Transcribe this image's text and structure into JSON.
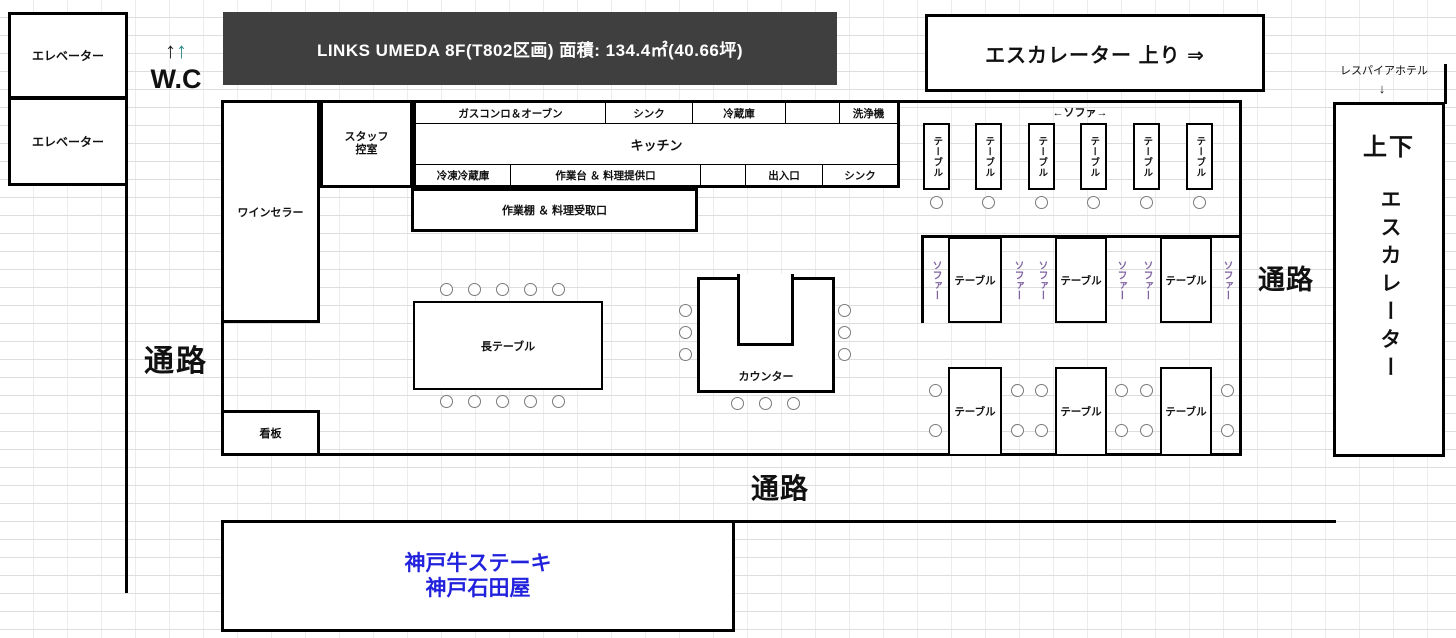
{
  "header": {
    "title": "LINKS UMEDA  8F(T802区画)  面積: 134.4㎡(40.66坪)",
    "bg_color": "#3F3F3F"
  },
  "left": {
    "elevator": "エレベーター",
    "wc": "W.C",
    "wc_arrow1": "↑",
    "wc_arrow2": "↑",
    "corridor": "通路"
  },
  "top_right": {
    "escalator_up": "エスカレーター 上り ⇒",
    "hotel": "レスパイアホテル",
    "hotel_arrow": "↓"
  },
  "right": {
    "corridor": "通路",
    "updown": "上下",
    "escalator": "エスカレーター"
  },
  "rooms": {
    "staff_line1": "スタッフ",
    "staff_line2": "控室",
    "wine_cellar": "ワインセラー",
    "signboard": "看板"
  },
  "kitchen": {
    "name": "キッチン",
    "row1": [
      "ガスコンロ＆オーブン",
      "シンク",
      "冷蔵庫",
      "",
      "洗浄機"
    ],
    "row2": [
      "冷凍冷蔵庫",
      "作業台 ＆ 料理提供口",
      "",
      "出入口",
      "シンク"
    ],
    "pickup": "作業棚 ＆ 料理受取口"
  },
  "dining": {
    "long_table": "長テーブル",
    "counter": "カウンター",
    "sofa_range": "←ソファ→",
    "table_v": "テーブル",
    "sofa_v": "ソファー",
    "table": "テーブル"
  },
  "bottom": {
    "corridor": "通路",
    "tenant_line1": "神戸牛ステーキ",
    "tenant_line2": "神戸石田屋"
  },
  "colors": {
    "header_bg": "#3F3F3F",
    "sofa_text": "#8064A2",
    "tenant_text": "#2222DD",
    "wc_arrow_teal": "#2E8B8B"
  }
}
